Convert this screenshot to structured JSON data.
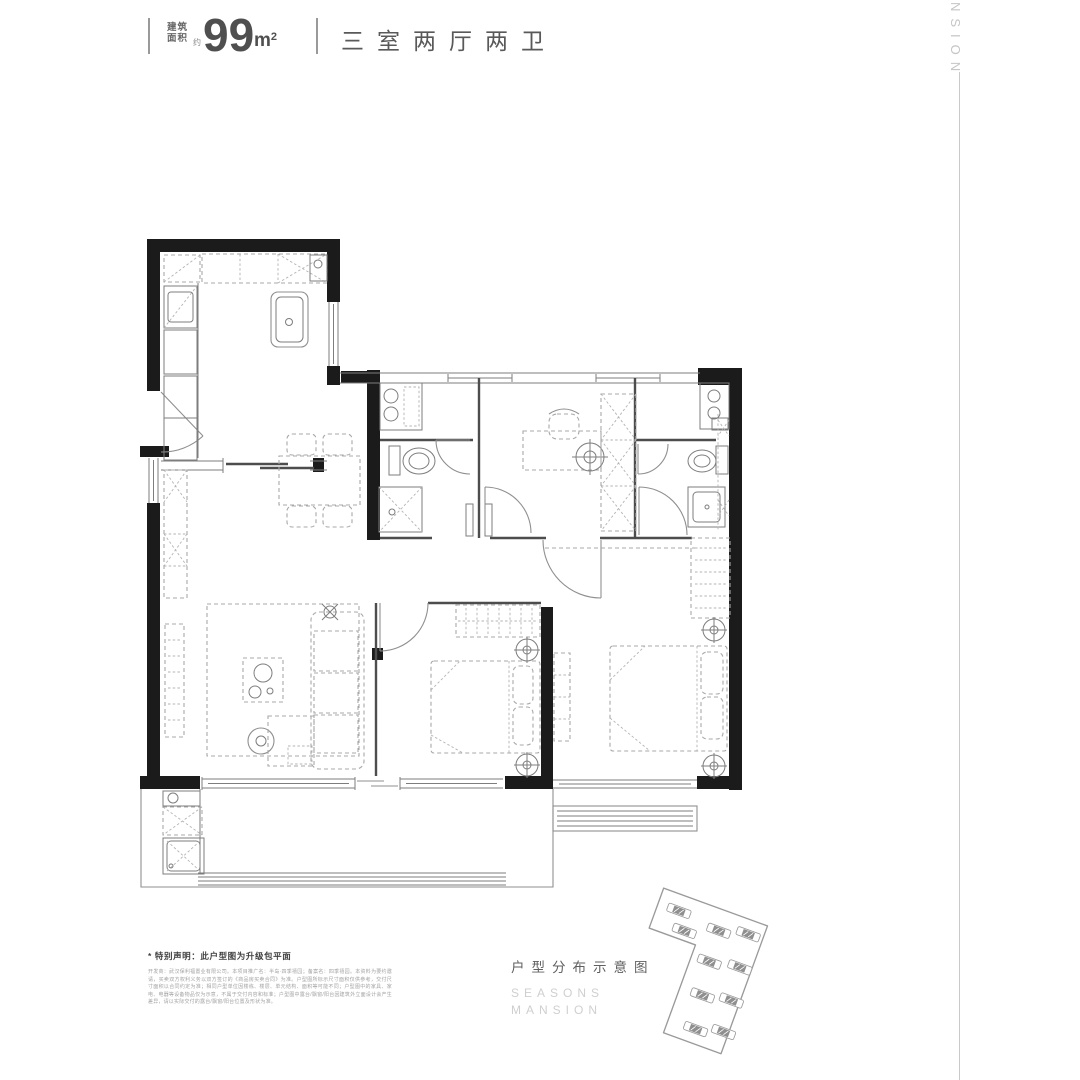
{
  "header": {
    "area_label_line1": "建筑",
    "area_label_line2": "面积",
    "approx_label": "约",
    "area_value": "99",
    "area_unit_base": "m",
    "area_unit_sup": "2",
    "layout_title": "三室两厅两卫"
  },
  "brand": {
    "vertical_text": "NSION"
  },
  "footer": {
    "note": "* 特别声明：此户型图为升级包平面",
    "legal_text": "开发商：武汉保利福置业有限公司。本项目推广名：半岛·四季禧园；备案名：四季禧园。本资料为要约邀请，买卖双方权利义务以双方签订的《商品房买卖合同》为准。户型图所标示尺寸面积仅供参考，交付尺寸面积以合同约定为准；相同户型单位因楼栋、楼层、单元结构、面积等可能不同；户型图中的家具、家电、电器等设备物品仅为示意，不属于交付内容和标准；户型图中露台/飘窗/阳台因建筑外立面设计会产生差异，请以实际交付的露台/飘窗/阳台位置及形状为准。",
    "distribution_label": "户型分布示意图",
    "brand_line1": "SEASONS",
    "brand_line2": "MANSION"
  },
  "colors": {
    "wall": "#1b1b1b",
    "thin_line": "#7d7d7d",
    "dashed_furniture": "#a8a8a8",
    "text_dark": "#4f4f4f",
    "text_mid": "#5f5f5f",
    "text_light": "#c6c6c6",
    "background": "#ffffff"
  }
}
